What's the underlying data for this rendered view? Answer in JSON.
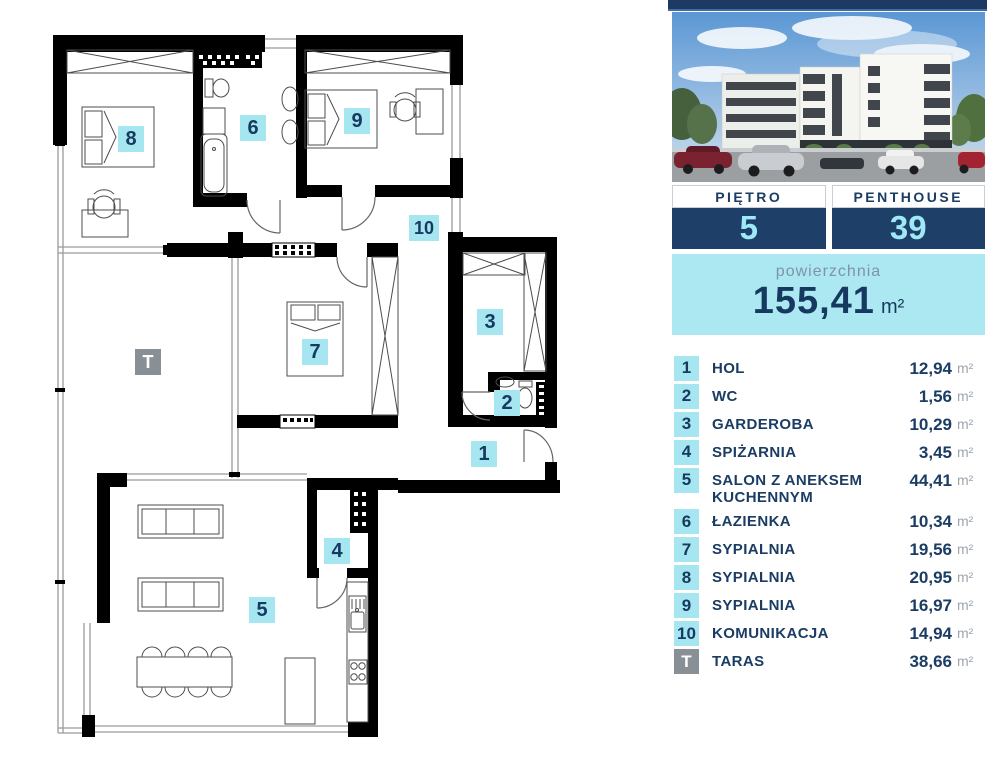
{
  "panel": {
    "floor_box": {
      "label": "PIĘTRO",
      "value": "5"
    },
    "unit_box": {
      "label": "PENTHOUSE",
      "value": "39"
    },
    "area_box": {
      "label": "powierzchnia",
      "value": "155,41",
      "unit": "m²"
    }
  },
  "legend": {
    "unit": "m²",
    "rooms": [
      {
        "id": "1",
        "name": "HOL",
        "area": "12,94"
      },
      {
        "id": "2",
        "name": "WC",
        "area": "1,56"
      },
      {
        "id": "3",
        "name": "GARDEROBA",
        "area": "10,29"
      },
      {
        "id": "4",
        "name": "SPIŻARNIA",
        "area": "3,45"
      },
      {
        "id": "5",
        "name": "SALON Z ANEKSEM KUCHENNYM",
        "area": "44,41"
      },
      {
        "id": "6",
        "name": "ŁAZIENKA",
        "area": "10,34"
      },
      {
        "id": "7",
        "name": "SYPIALNIA",
        "area": "19,56"
      },
      {
        "id": "8",
        "name": "SYPIALNIA",
        "area": "20,95"
      },
      {
        "id": "9",
        "name": "SYPIALNIA",
        "area": "16,97"
      },
      {
        "id": "10",
        "name": "KOMUNIKACJA",
        "area": "14,94"
      },
      {
        "id": "T",
        "name": "TARAS",
        "area": "38,66",
        "badge": "gray"
      }
    ]
  },
  "plan": {
    "badges": [
      {
        "id": "1",
        "x": 471,
        "y": 441,
        "color": "cyan"
      },
      {
        "id": "2",
        "x": 494,
        "y": 390,
        "color": "cyan"
      },
      {
        "id": "3",
        "x": 477,
        "y": 309,
        "color": "cyan"
      },
      {
        "id": "4",
        "x": 324,
        "y": 538,
        "color": "cyan"
      },
      {
        "id": "5",
        "x": 249,
        "y": 597,
        "color": "cyan"
      },
      {
        "id": "6",
        "x": 240,
        "y": 115,
        "color": "cyan"
      },
      {
        "id": "7",
        "x": 302,
        "y": 339,
        "color": "cyan"
      },
      {
        "id": "8",
        "x": 118,
        "y": 126,
        "color": "cyan"
      },
      {
        "id": "9",
        "x": 344,
        "y": 108,
        "color": "cyan"
      },
      {
        "id": "10",
        "x": 409,
        "y": 215,
        "color": "cyan",
        "wide": true
      },
      {
        "id": "T",
        "x": 135,
        "y": 349,
        "color": "gray"
      }
    ]
  },
  "colors": {
    "navy_text": "#1B3C63",
    "navy_box": "#1D3F68",
    "cyan_badge": "#A6E6F1",
    "cyan_area_box": "#ACE8F2",
    "number_cyan": "#9FE9F7",
    "gray_badge": "#899095",
    "unit_gray": "#9CA6AE",
    "wall_black": "#000000"
  }
}
